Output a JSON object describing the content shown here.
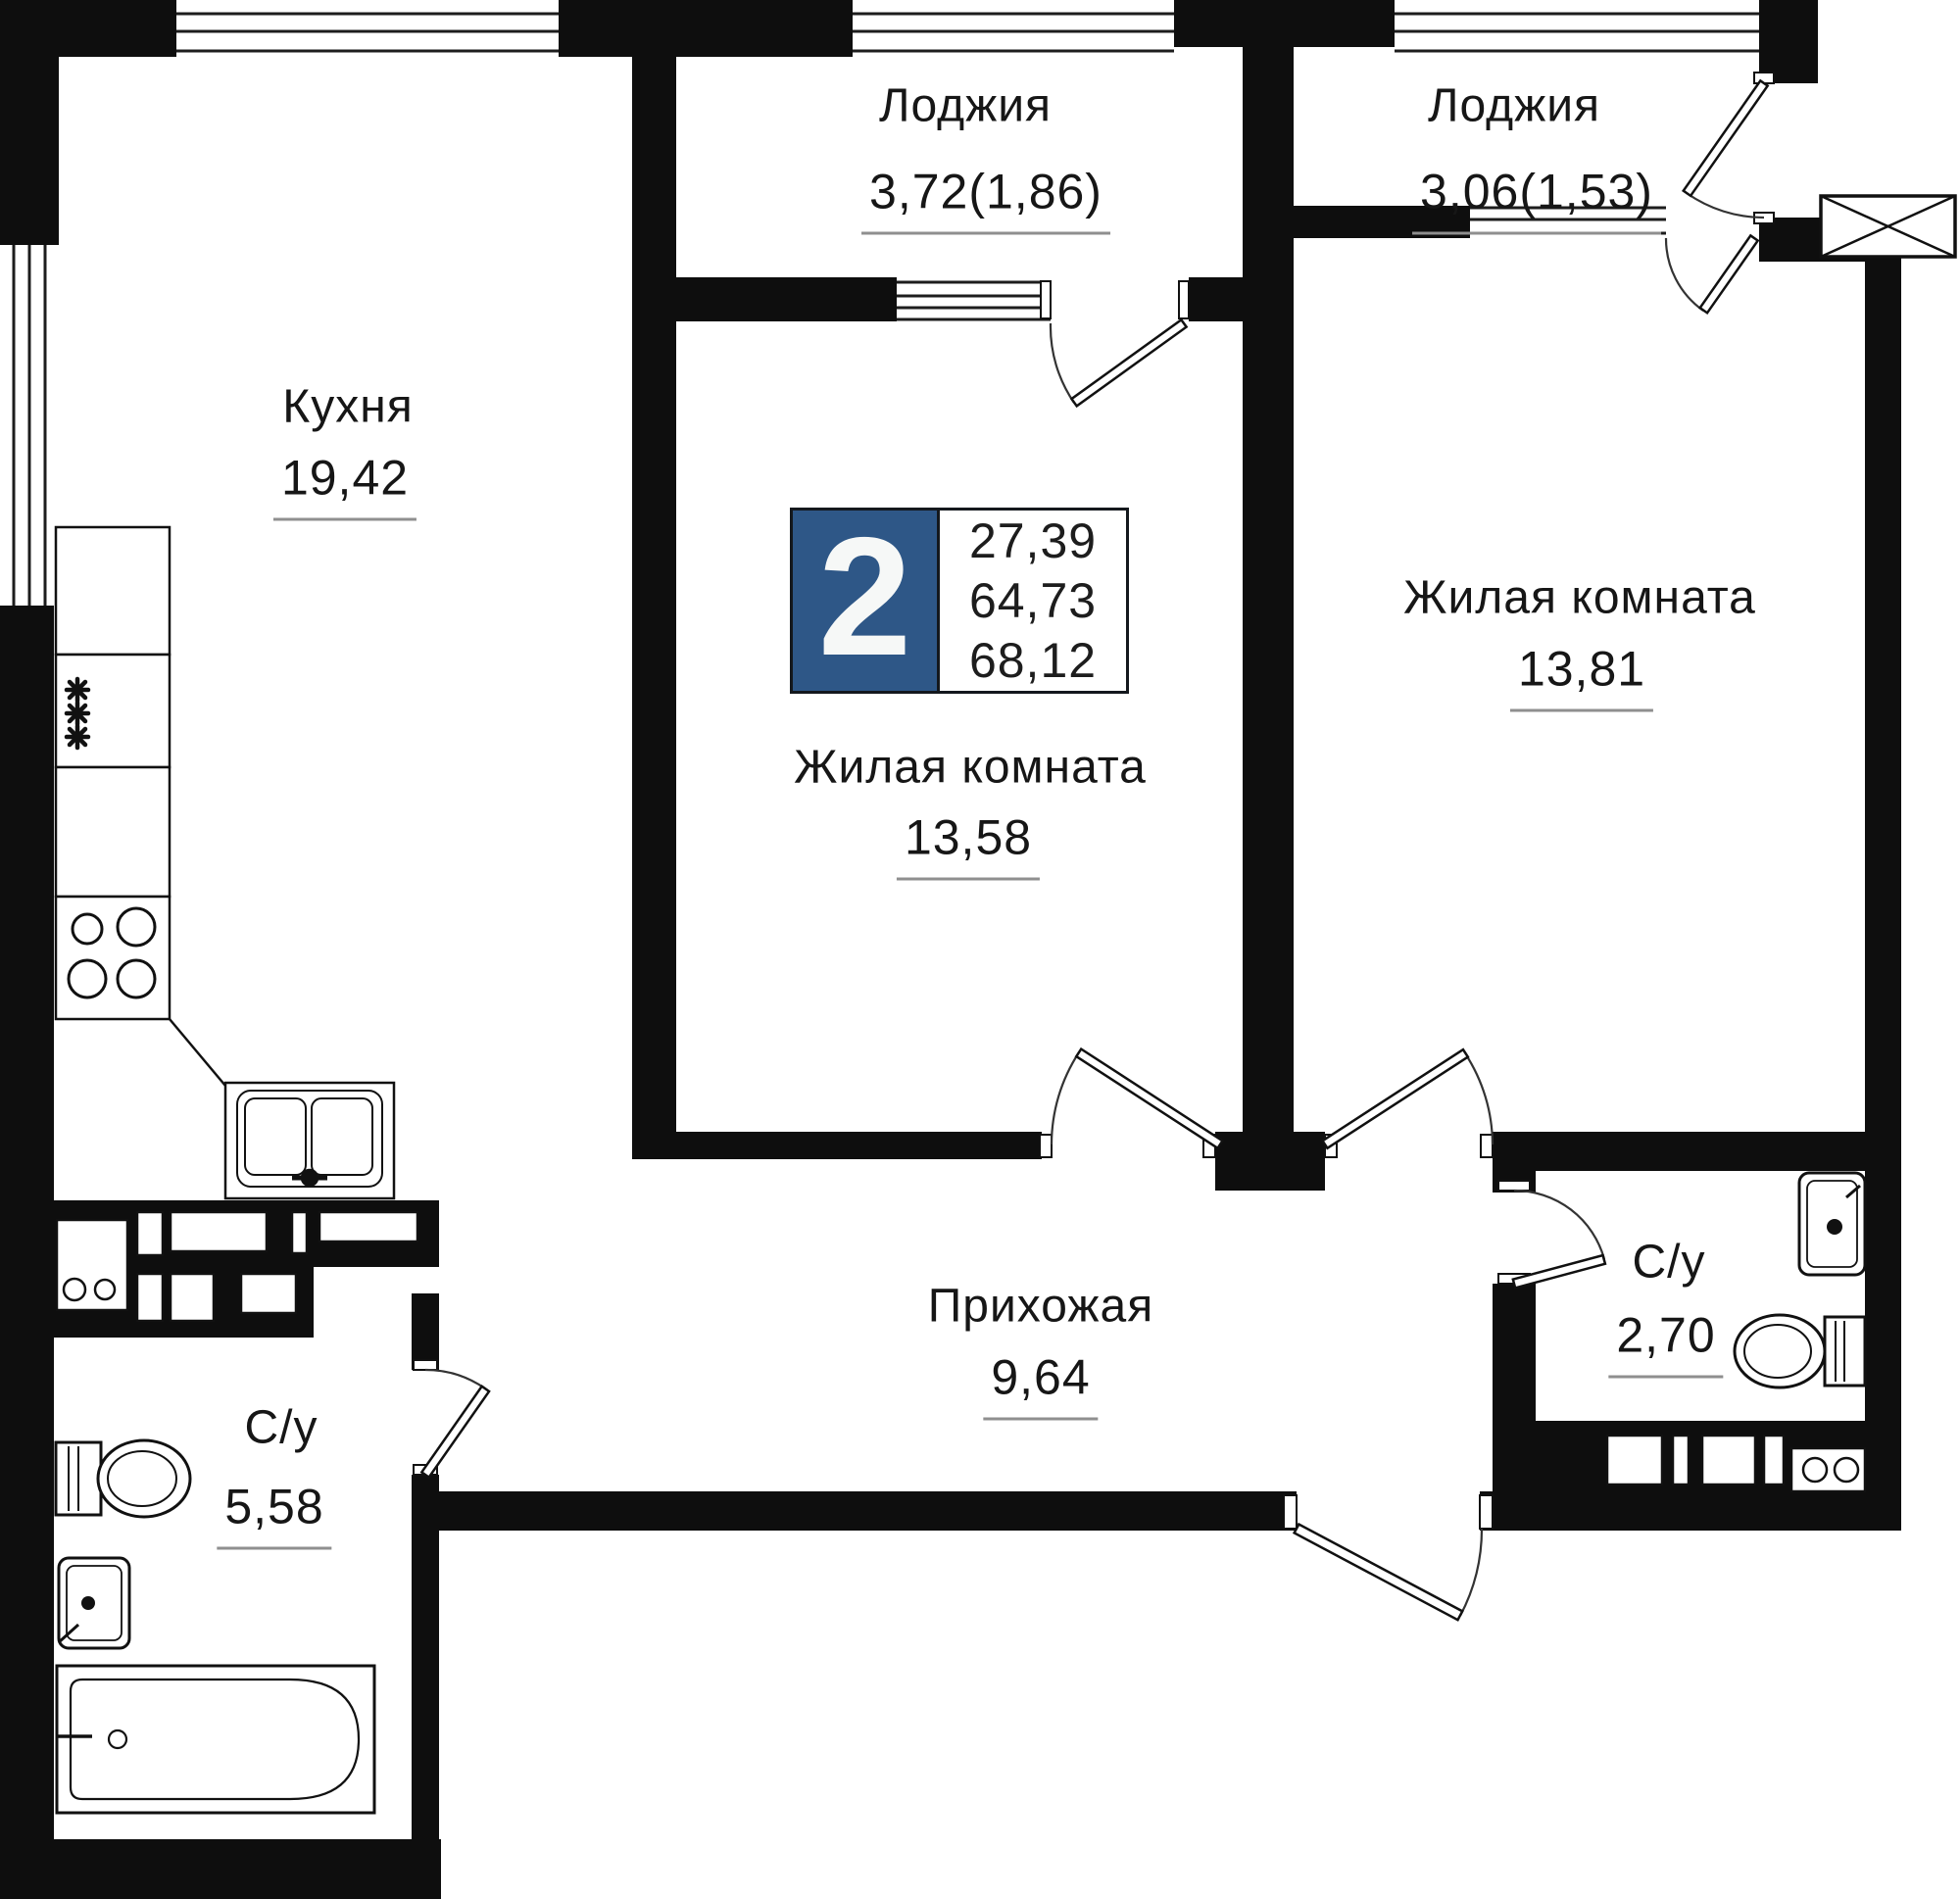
{
  "plan": {
    "type": "apartment-floor-plan",
    "badge": {
      "room_count": "2",
      "areas": [
        "27,39",
        "64,73",
        "68,12"
      ]
    },
    "rooms": {
      "kitchen": {
        "name": "Кухня",
        "area": "19,42",
        "fixtures": [
          "cabinets",
          "fridge",
          "stove",
          "kitchen-sink",
          "washing-machine"
        ]
      },
      "loggia1": {
        "name": "Лоджия",
        "area": "3,72(1,86)",
        "fixtures": []
      },
      "loggia2": {
        "name": "Лоджия",
        "area": "3,06(1,53)",
        "fixtures": []
      },
      "living1": {
        "name": "Жилая комната",
        "area": "13,58",
        "fixtures": []
      },
      "living2": {
        "name": "Жилая комната",
        "area": "13,81",
        "fixtures": []
      },
      "hallway": {
        "name": "Прихожая",
        "area": "9,64",
        "fixtures": []
      },
      "bath1": {
        "name": "С/у",
        "area": "5,58",
        "fixtures": [
          "toilet",
          "sink",
          "bathtub"
        ]
      },
      "bath2": {
        "name": "С/у",
        "area": "2,70",
        "fixtures": [
          "sink",
          "toilet",
          "washer"
        ]
      }
    },
    "colors": {
      "wall": "#0e0e0e",
      "background": "#ffffff",
      "badge_blue": "#2e5787",
      "underline": "#8f8f8f",
      "text": "#161616"
    }
  }
}
